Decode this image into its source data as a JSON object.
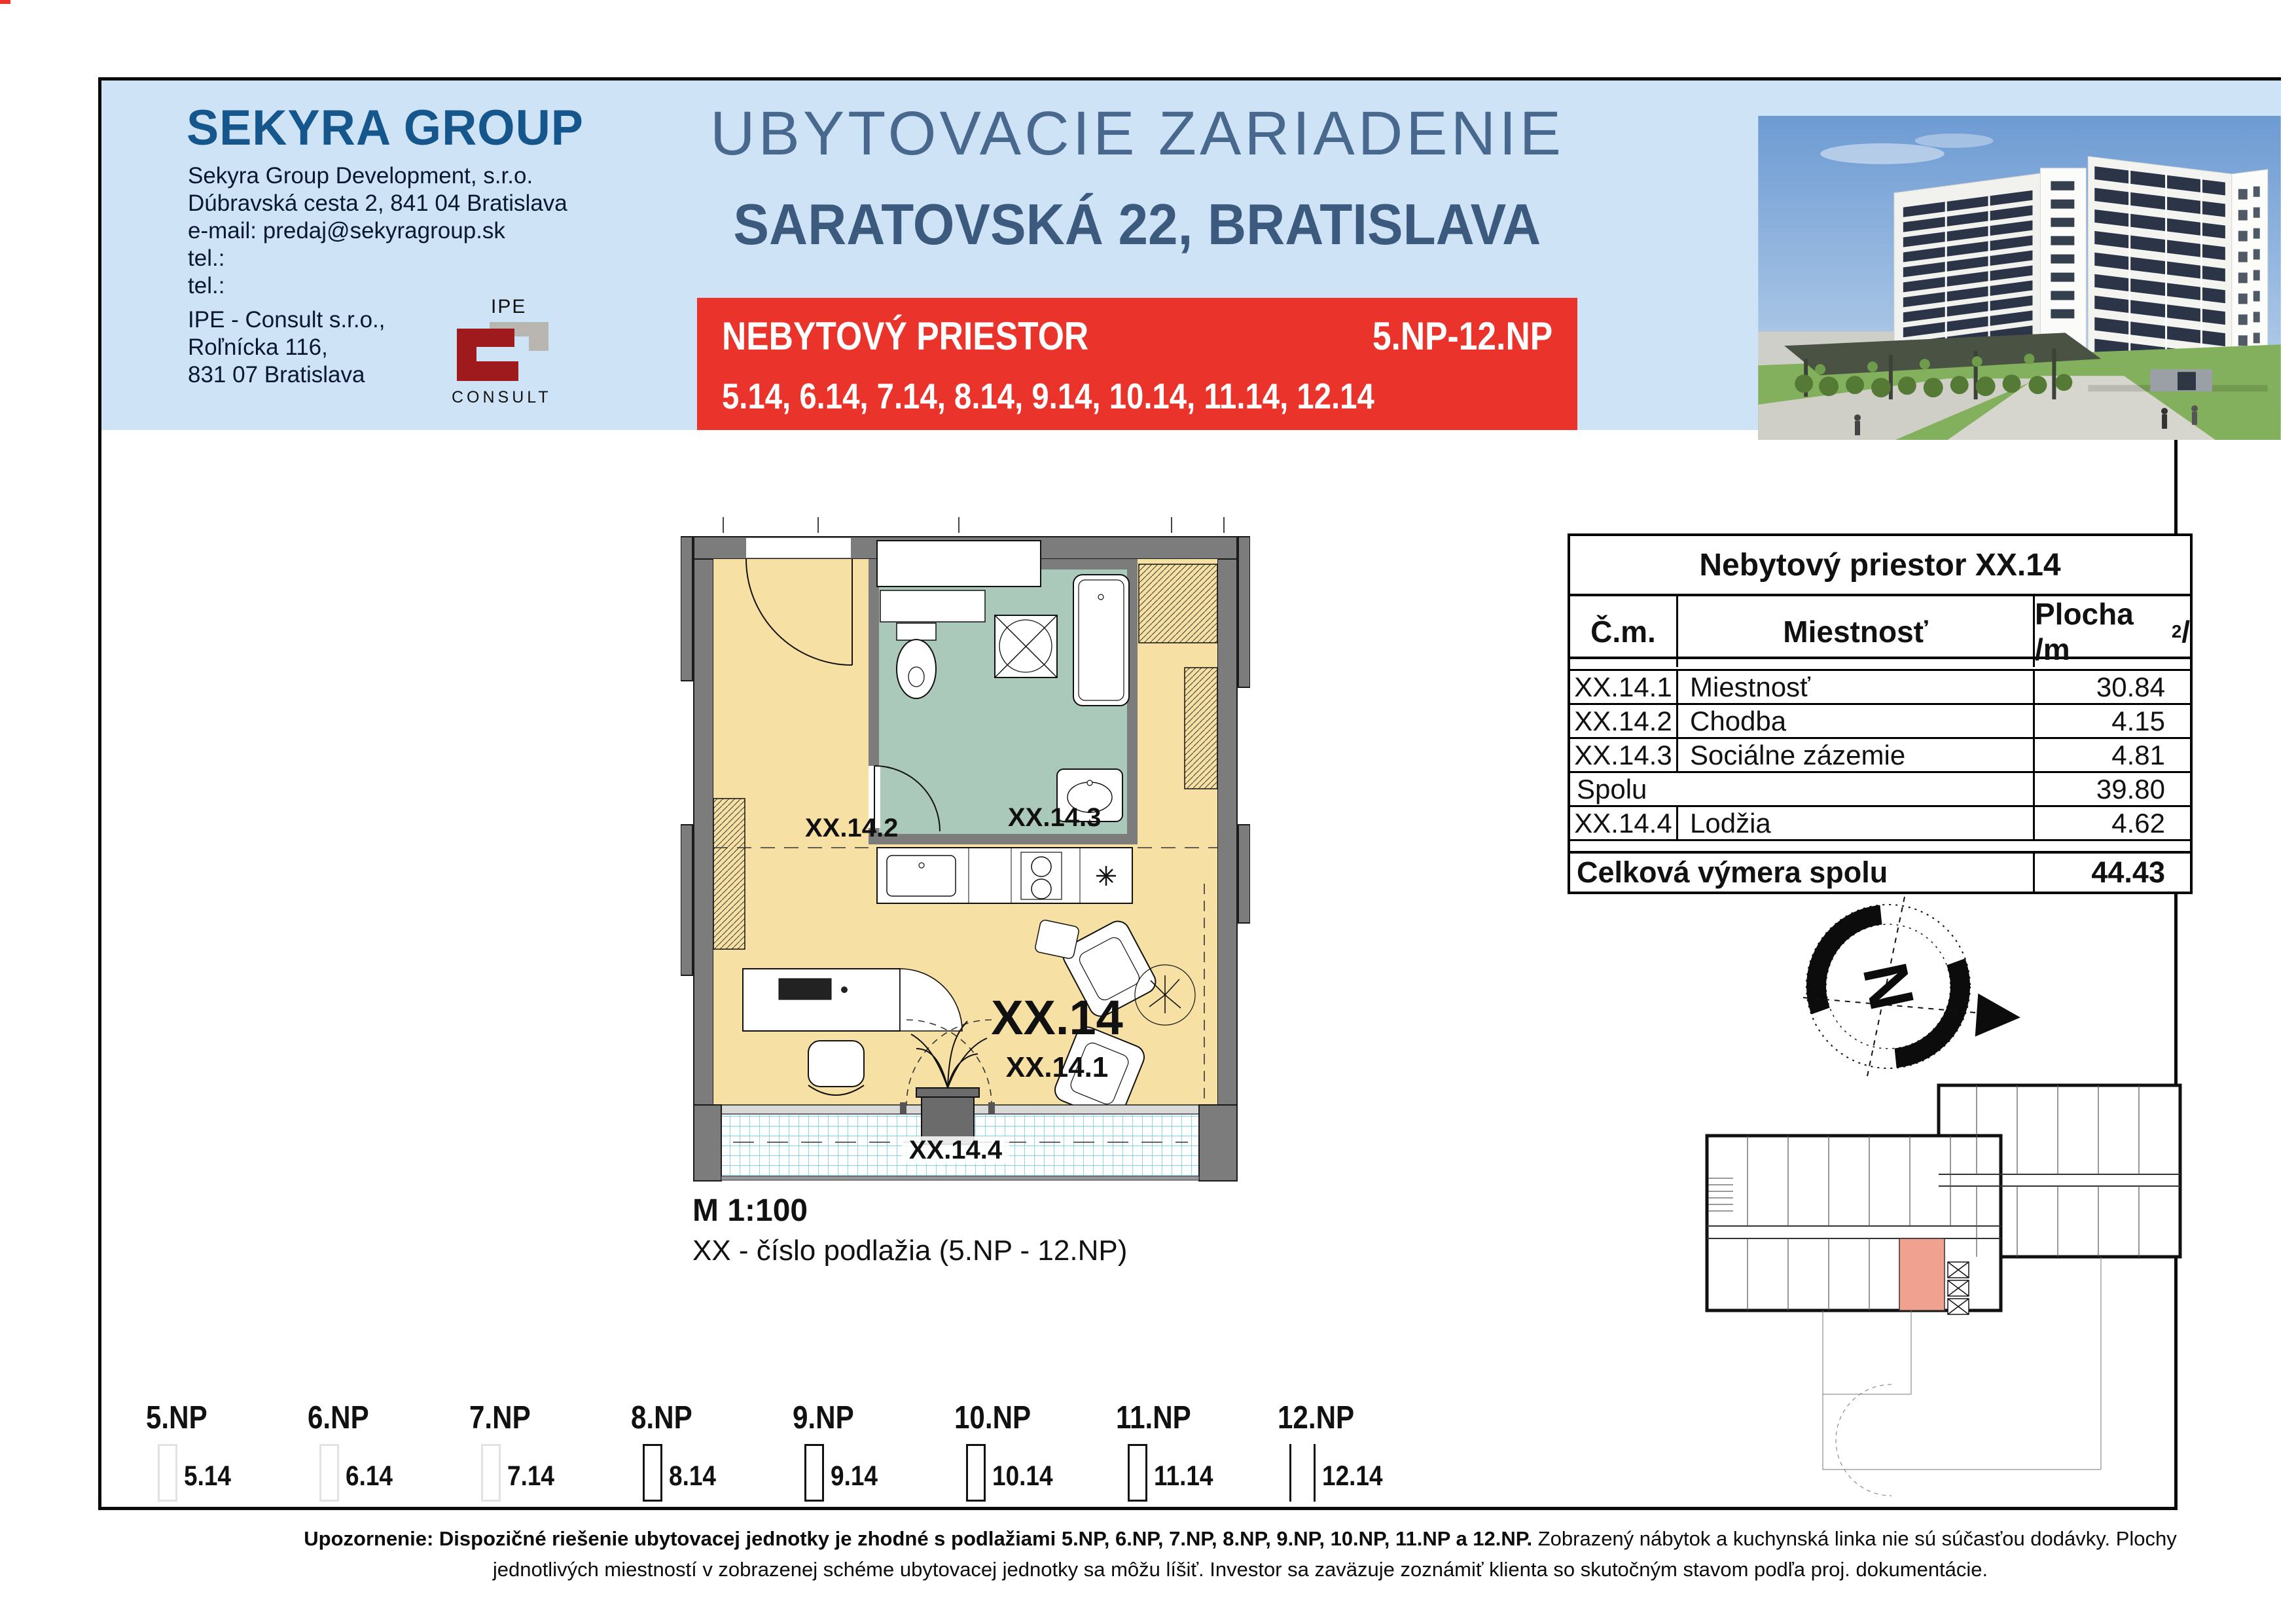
{
  "header": {
    "logo_text": "SEKYRA GROUP",
    "company_lines": [
      "Sekyra Group Development, s.r.o.",
      "Dúbravská cesta 2, 841 04 Bratislava",
      "e-mail: predaj@sekyragroup.sk",
      "tel.:",
      "tel.:"
    ],
    "consultant_lines": [
      "IPE - Consult s.r.o.,",
      "Roľnícka 116,",
      "831 07 Bratislava"
    ],
    "ipe_logo_top": "IPE",
    "ipe_logo_bottom": "CONSULT",
    "title_line1": "UBYTOVACIE ZARIADENIE",
    "title_line2": "SARATOVSKÁ 22, BRATISLAVA",
    "banner_left": "NEBYTOVÝ PRIESTOR",
    "banner_right": "5.NP-12.NP",
    "banner_units": "5.14, 6.14, 7.14, 8.14, 9.14, 10.14, 11.14, 12.14"
  },
  "floorplan": {
    "label_hall": "XX.14.2",
    "label_bath": "XX.14.3",
    "label_unit": "XX.14",
    "label_room": "XX.14.1",
    "label_loggia": "XX.14.4",
    "scale": "M 1:100",
    "note": "XX - číslo podlažia (5.NP - 12.NP)"
  },
  "compass": {
    "letter": "N"
  },
  "table": {
    "title": "Nebytový priestor XX.14",
    "col1": "Č.m.",
    "col2": "Miestnosť",
    "col3_prefix": "Plocha /m",
    "col3_sup": "2",
    "col3_suffix": "/",
    "rows": [
      {
        "no": "XX.14.1",
        "room": "Miestnosť",
        "area": "30.84"
      },
      {
        "no": "XX.14.2",
        "room": "Chodba",
        "area": "4.15"
      },
      {
        "no": "XX.14.3",
        "room": "Sociálne zázemie",
        "area": "4.81"
      }
    ],
    "subtotal_label": "Spolu",
    "subtotal_value": "39.80",
    "extra_row": {
      "no": "XX.14.4",
      "room": "Lodžia",
      "area": "4.62"
    },
    "total_label": "Celková výmera spolu",
    "total_value": "44.43"
  },
  "floors": {
    "items": [
      {
        "floor": "5.NP",
        "unit": "5.14"
      },
      {
        "floor": "6.NP",
        "unit": "6.14"
      },
      {
        "floor": "7.NP",
        "unit": "7.14"
      },
      {
        "floor": "8.NP",
        "unit": "8.14"
      },
      {
        "floor": "9.NP",
        "unit": "9.14"
      },
      {
        "floor": "10.NP",
        "unit": "10.14"
      },
      {
        "floor": "11.NP",
        "unit": "11.14"
      },
      {
        "floor": "12.NP",
        "unit": "12.14"
      }
    ]
  },
  "footer": {
    "bold": "Upozornenie: Dispozičné riešenie ubytovacej jednotky je zhodné s podlažiami 5.NP, 6.NP, 7.NP, 8.NP, 9.NP, 10.NP, 11.NP a 12.NP.",
    "normal": " Zobrazený nábytok a kuchynská linka nie sú súčasťou dodávky. Plochy jednotlivých miestností v zobrazenej schéme ubytovacej jednotky sa môžu líšiť. Investor sa zaväzuje zoznámiť klienta so skutočným stavom podľa proj. dokumentácie."
  },
  "colors": {
    "band_bg": "#cfe3f6",
    "accent_red": "#e9332b",
    "title_blue": "#49688e",
    "subtitle_blue": "#3c5a7e",
    "logo_blue": "#15568c",
    "ipe_red": "#9e1a1d",
    "plan_room": "#f6e0a3",
    "plan_bath": "#aac9ba",
    "plan_wall": "#7c7c7c",
    "loggia_grid": "#59c6e4",
    "highlight_salmon": "#f0a18f"
  }
}
